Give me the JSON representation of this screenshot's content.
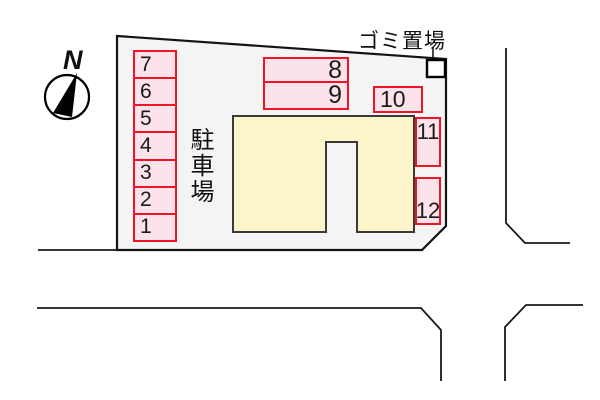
{
  "compass": {
    "north_label": "N"
  },
  "labels": {
    "parking_lot": "駐車場",
    "garbage_area": "ゴミ置場"
  },
  "parking_spaces": {
    "left_column": [
      "7",
      "6",
      "5",
      "4",
      "3",
      "2",
      "1"
    ],
    "upper_row": [
      "8",
      "9"
    ],
    "middle_row": [
      "10"
    ],
    "right_column": [
      "11",
      "12"
    ]
  },
  "colors": {
    "page_bg": "#ffffff",
    "site_fill": "#f4f4f4",
    "site_border": "#141414",
    "building_fill": "#fcf5c9",
    "building_border": "#3a3a3a",
    "space_fill": "#fce2eb",
    "space_border": "#f01426",
    "road_line": "#1a1a1a"
  }
}
